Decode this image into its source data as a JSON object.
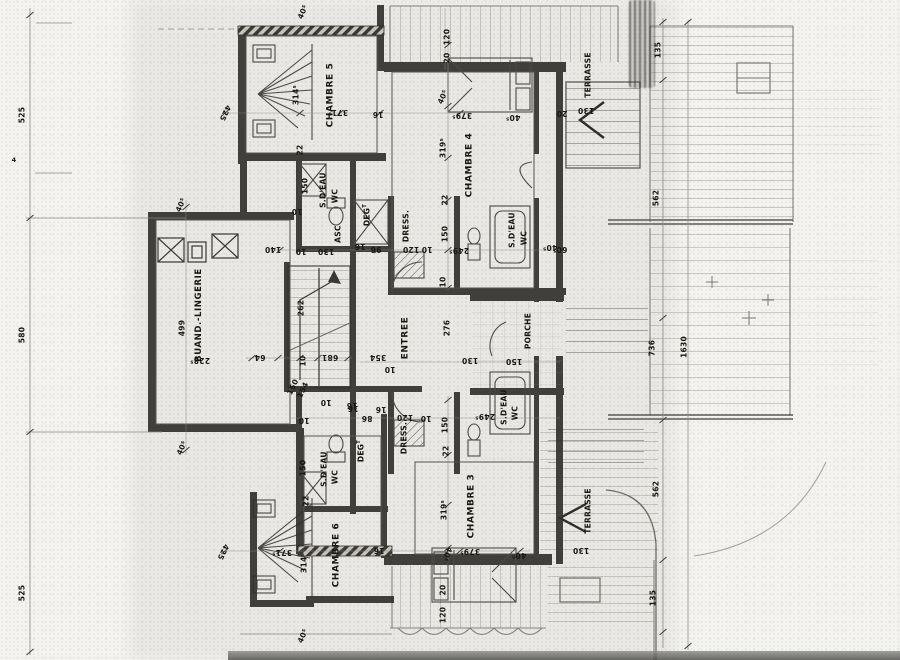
{
  "colors": {
    "ink": "#2e2c29",
    "paper": "#f4f3f0",
    "pencil": "#8d8b86"
  },
  "rooms": {
    "chambre5": "CHAMBRE 5",
    "chambre4": "CHAMBRE 4",
    "chambre3": "CHAMBRE 3",
    "chambre6": "CHAMBRE 6",
    "buanderie": "BUAND.-LINGERIE",
    "entree": "ENTREE",
    "porche": "PORCHE",
    "ascenseur": "ASC",
    "degagement": "DEG",
    "degagement_sup": "T",
    "dressing": "DRESS.",
    "salle_eau": "S.D'EAU",
    "wc": "WC",
    "terrasse": "TERRASSE"
  },
  "dims": {
    "d525": "525",
    "d580": "580",
    "d4": "4",
    "d135": "135",
    "d562": "562",
    "d736": "736",
    "d1630": "1630",
    "d120": "120",
    "d20": "20",
    "d130": "130",
    "d140": "140",
    "d150": "150",
    "d10": "10",
    "d16": "16",
    "d22": "22",
    "d86": "86",
    "d96": "96",
    "d64": "64",
    "d681": "681",
    "d154": "154",
    "d262": "262",
    "d276": "276",
    "d354": "354",
    "d425": "425",
    "d499": "499",
    "d40_5": "40⁵",
    "d60_5": "60⁵",
    "d228_5": "228⁵",
    "d249_5": "249⁵",
    "d314_5": "314⁵",
    "d319_5": "319⁵",
    "d371_5": "371⁵",
    "d379_5": "379⁵"
  }
}
